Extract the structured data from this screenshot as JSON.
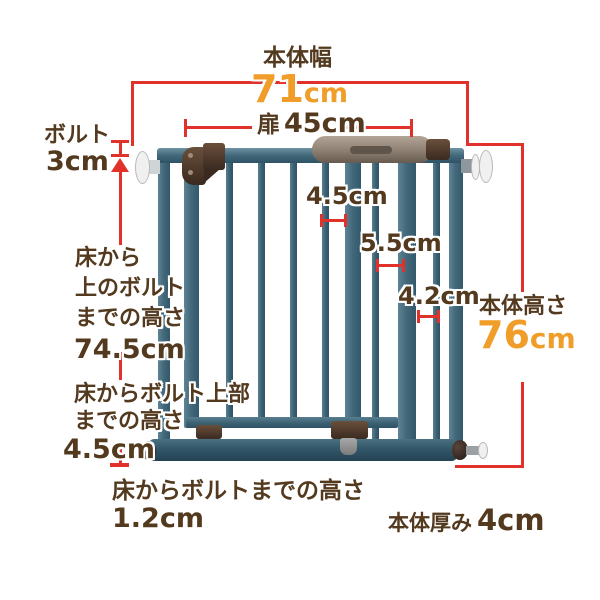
{
  "colors": {
    "dimension_red": "#e0322a",
    "value_orange": "#f09d2a",
    "text_brown": "#53391e",
    "gate_teal": "#44697b"
  },
  "annotations": {
    "body_width": {
      "label": "本体幅",
      "value": "71",
      "unit": "cm"
    },
    "door_width": {
      "prefix": "扉",
      "value": "45cm"
    },
    "bolt": {
      "label": "ボルト",
      "value": "3cm"
    },
    "floor_to_upper_bolt": {
      "lines": [
        "床から",
        "上のボルト",
        "までの高さ"
      ],
      "value": "74.5cm"
    },
    "floor_to_bolt_top": {
      "lines": [
        "床からボルト上部",
        "までの高さ"
      ],
      "value": "4.5cm"
    },
    "floor_to_bolt": {
      "lines": [
        "床からボルトまでの高さ"
      ],
      "value": "1.2cm"
    },
    "body_height": {
      "label": "本体高さ",
      "value": "76",
      "unit": "cm"
    },
    "body_thickness": {
      "label": "本体厚み",
      "value": "4cm"
    },
    "bar_gap_1": {
      "value": "4.5cm"
    },
    "bar_gap_2": {
      "value": "5.5cm"
    },
    "bar_gap_3": {
      "value": "4.2cm"
    }
  }
}
